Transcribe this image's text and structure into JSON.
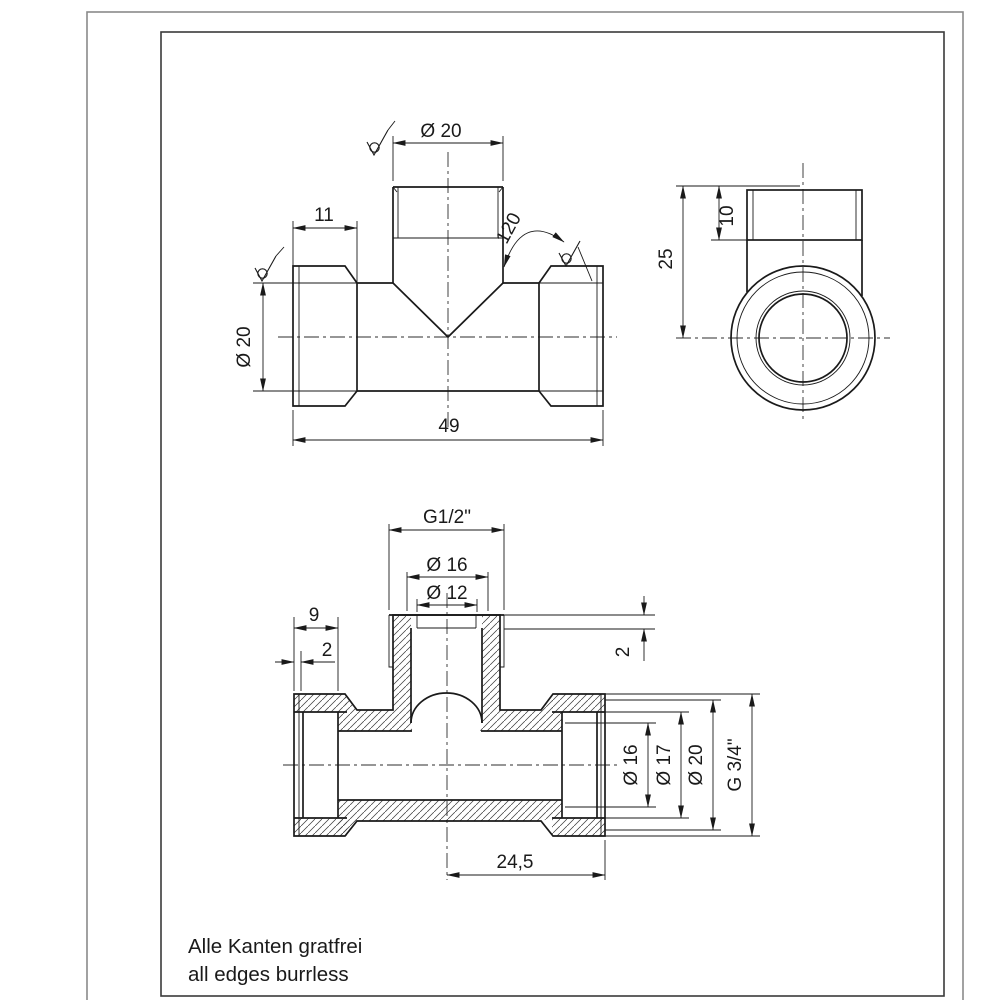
{
  "colors": {
    "background": "#ffffff",
    "line": "#1a1a1a",
    "frame": "#3a3a3a",
    "outer_border": "#8a8a8a",
    "hatch": "#3a3a3a"
  },
  "symbols": {
    "surface_finish": "surface-finish-symbol (circle in check mark)"
  },
  "notes": {
    "de": "Alle Kanten gratfrei",
    "en": "all edges burrless"
  },
  "front_view": {
    "branch_diameter": "Ø 20",
    "thread_length": "11",
    "cone_angle": "120",
    "body_diameter": "Ø 20",
    "overall_length": "49"
  },
  "side_view": {
    "thread_length": "10",
    "branch_height": "25"
  },
  "section_view": {
    "branch_thread": "G1/2\"",
    "counterbore_diameter": "Ø 16",
    "bore_diameter": "Ø 12",
    "thread_depth": "9",
    "relief_left": "2",
    "relief_right": "2",
    "bore_16": "Ø 16",
    "bore_17": "Ø 17",
    "outer_20": "Ø 20",
    "end_thread": "G 3/4\"",
    "end_length": "24,5"
  }
}
